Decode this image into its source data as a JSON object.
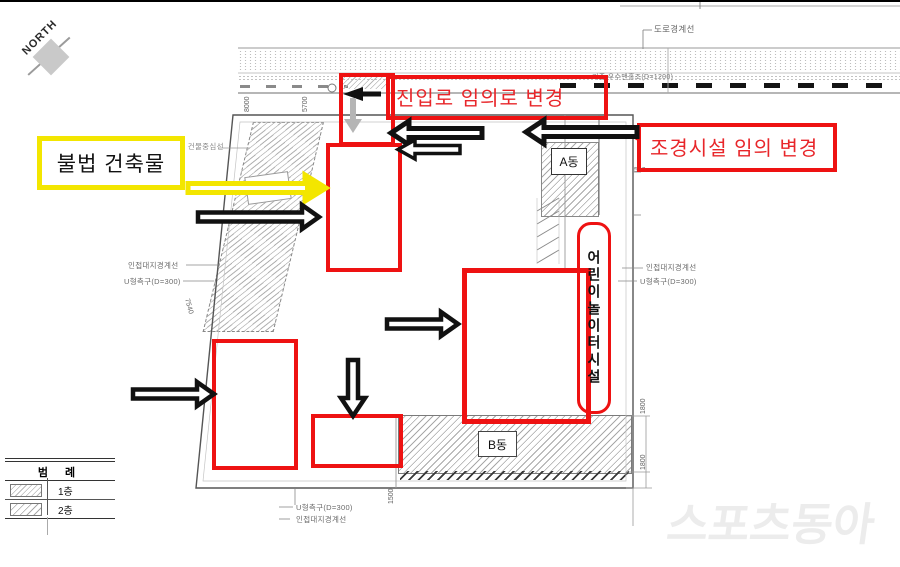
{
  "compass": {
    "label": "NORTH"
  },
  "annotations": {
    "illegal_building": "불법 건축물",
    "access_road_change": "진입로 임의로 변경",
    "landscape_change": "조경시설 임의 변경",
    "vertical_note": "어린이놀이터시설"
  },
  "plan": {
    "labels": {
      "road_boundary": "도로경계선",
      "storm_manhole": "기존 우수맨홀조(D=1200)",
      "new_building_centerline": "신축 건물중심선",
      "adjacent_boundary_left": "인접대지경계선",
      "u_gutter_left": "U형측구(D=300)",
      "adjacent_boundary_right": "인접대지경계선",
      "u_gutter_right": "U형측구(D=300)",
      "u_gutter_bottom": "U형측구(D=300)",
      "adjacent_boundary_bottom": "인접대지경계선",
      "building_a": "A동",
      "building_b": "B동",
      "cs_room": "CS"
    },
    "dims": {
      "d7540": "7540",
      "d8000": "8000",
      "d5700": "5700",
      "d500": "500",
      "d1500": "1500",
      "d1800_a": "1800",
      "d1800_b": "1800"
    }
  },
  "legend": {
    "title": "범 례",
    "items": [
      {
        "label": "1층"
      },
      {
        "label": "2층"
      }
    ]
  },
  "watermark": {
    "text": "스포츠동아"
  },
  "colors": {
    "annotation_red": "#ee1212",
    "annotation_text_red": "#e8262a",
    "highlight_yellow": "#f3e600",
    "drawing_gray": "#6a6a6a"
  }
}
